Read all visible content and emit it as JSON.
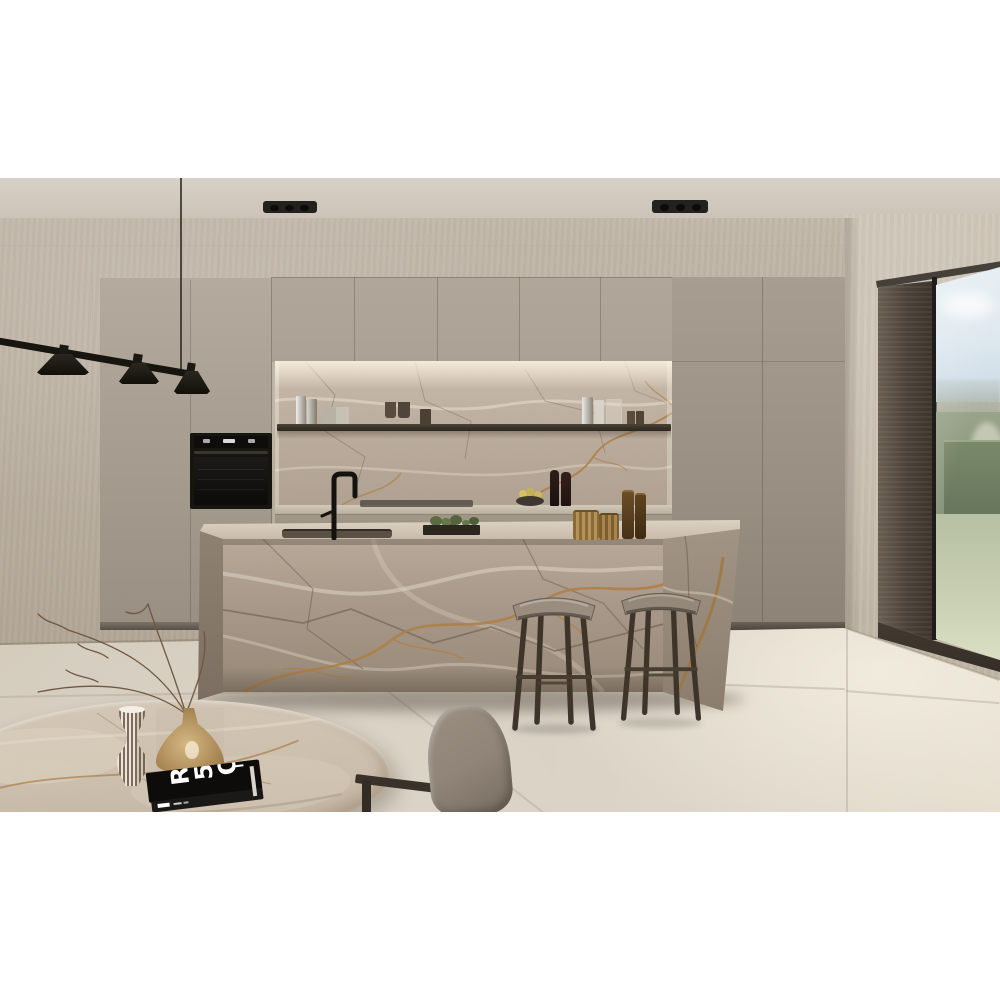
{
  "image": {
    "kind": "photograph",
    "subject": "Modern minimalist kitchen with brown-grey marble waterfall island and backsplash, greige handleless cabinetry, black fixtures, and a corner window onto a garden",
    "lighting": "soft warm daylight"
  },
  "objects": [
    {
      "name": "ceiling-spotlights",
      "label": "Two black rectangular recessed ceiling spotlights"
    },
    {
      "name": "pendant-light",
      "label": "Black linear pendant with three cone shades over dining area"
    },
    {
      "name": "tall-cabinets-left",
      "label": "Greige floor-to-ceiling cabinets with built-in black oven"
    },
    {
      "name": "upper-cabinets",
      "label": "Greige upper cabinet row above the backsplash niche"
    },
    {
      "name": "backsplash",
      "label": "Brown-grey marble backsplash with under-cabinet lighting"
    },
    {
      "name": "metal-shelf",
      "label": "Slim dark metal shelf holding steel tumblers, cups and glassware"
    },
    {
      "name": "counter-decor",
      "label": "Fruit bowl with lemons and two dark bottles on the back counter"
    },
    {
      "name": "island",
      "label": "Waterfall marble island with black faucet, sink, herb planter and amber glass vessels"
    },
    {
      "name": "bar-stools",
      "label": "Two dark wooden bar stools with grey saddle seats"
    },
    {
      "name": "tall-cabinets-right",
      "label": "Tall greige cabinet wall right of the niche"
    },
    {
      "name": "window",
      "label": "Dark-wood framed picture window with view of hedges, trees and lawn"
    },
    {
      "name": "floor",
      "label": "Large-format beige stone floor tiles"
    },
    {
      "name": "dining-table",
      "label": "Rounded marble dining table in the foreground"
    },
    {
      "name": "striped-vase",
      "label": "White gourd-shaped vase with fine brown stripes"
    },
    {
      "name": "amber-vase",
      "label": "Speckled amber cone vase holding dry branches"
    },
    {
      "name": "book",
      "label": "Black coffee-table book with white graphic cover"
    },
    {
      "name": "chair",
      "label": "Grey upholstered dining chair with dark wood frame"
    }
  ],
  "palette": {
    "ceil1": "#d8d1c7",
    "ceil2": "#c5bcaf",
    "wall1": "#c2b8aa",
    "wall2": "#b2a797",
    "wallR": "#cdc4b5",
    "cabUp": "#aba295",
    "cabL1": "#b4ab9e",
    "cabL2": "#998f82",
    "cabR1": "#a79e91",
    "cabR2": "#8d8376",
    "toe": "#6b6257",
    "marbLight": "#e8ddcd",
    "marbMid": "#b2a392",
    "marbDark": "#5f4f40",
    "rust": "#b07c3f",
    "floor1": "#d6cebf",
    "floor2": "#e4ddce",
    "seam": "#b1a694",
    "black": "#17150f",
    "steel": "#d9d6cf",
    "glassDark": "#4a4034",
    "wood1": "#6a5e51",
    "wood2": "#3d352c",
    "sill": "#332d26",
    "sky": "#dfe9f0",
    "hill": "#a7ae9d",
    "hedge": "#87947a",
    "hedgeD": "#66755a",
    "lawn": "#c6cdb1",
    "lawnL": "#dadfc4",
    "seat": "#9a8d7f",
    "legWood": "#3e342a",
    "chairFab": "#8f8477",
    "chairWood": "#3a322a",
    "tableM": "#cec0ae",
    "vaseW": "#ece4d6",
    "stripe": "#503a2c",
    "amber": "#b5925c",
    "bookC": "#0d0c0b",
    "pages": "#d8d4cb",
    "plant": "#5d6b42",
    "fruit": "#d4c065",
    "glow": "#fff3dd"
  }
}
